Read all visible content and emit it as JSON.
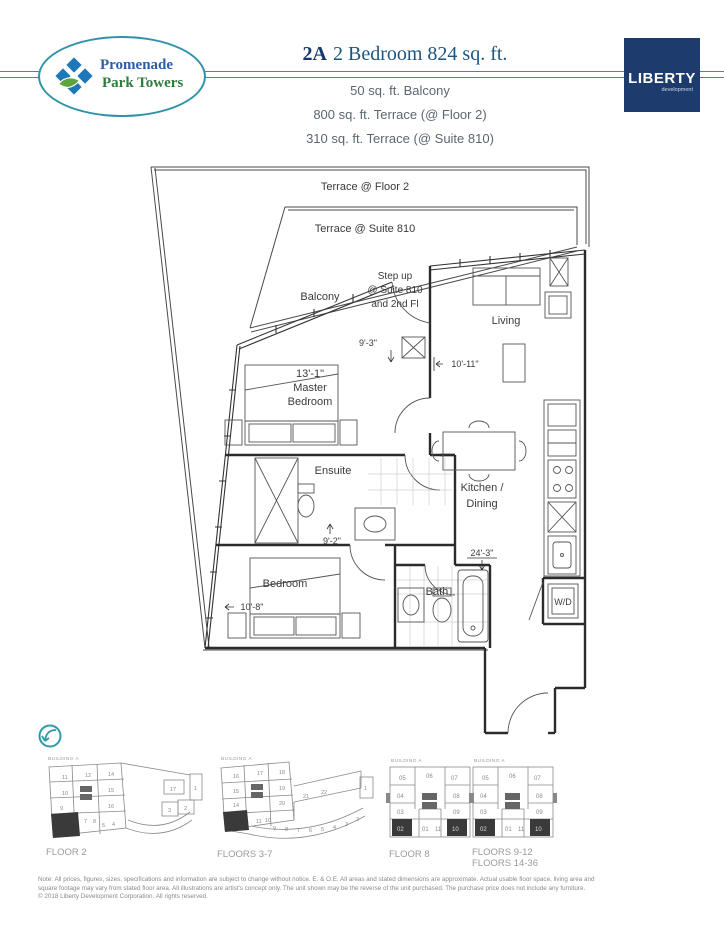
{
  "header": {
    "logo_line1": "Promenade",
    "logo_line2": "Park Towers",
    "unit_code": "2A",
    "unit_desc": "2 Bedroom 824 sq. ft.",
    "subtitles": [
      "50 sq. ft. Balcony",
      "800 sq. ft. Terrace (@ Floor 2)",
      "310 sq. ft. Terrace (@ Suite 810)"
    ],
    "developer_name": "LIBERTY",
    "developer_sub": "development"
  },
  "colors": {
    "brand_teal": "#2e93a9",
    "logo_blue": "#2b5ea7",
    "logo_green": "#2e7d3f",
    "title_navy": "#14386e",
    "liberty_navy": "#1d3c6d",
    "plan_line": "#2b2b2b",
    "keyplan_gray": "#8a8a8a"
  },
  "floorplan": {
    "terrace_floor2": "Terrace @ Floor 2",
    "terrace_suite": "Terrace @ Suite 810",
    "balcony": "Balcony",
    "step_up_1": "Step up",
    "step_up_2": "@ Suite 810",
    "step_up_3": "and 2nd Fl",
    "living": "Living",
    "master_dim": "13'-1\"",
    "master_1": "Master",
    "master_2": "Bedroom",
    "ensuite": "Ensuite",
    "kitchen_1": "Kitchen /",
    "kitchen_2": "Dining",
    "bedroom": "Bedroom",
    "bath": "Bath",
    "wd": "W/D",
    "dim_9_3": "9'-3\"",
    "dim_10_11": "10'-11\"",
    "dim_9_2": "9'-2\"",
    "dim_10_8": "10'-8\"",
    "dim_24_3": "24'-3\""
  },
  "keyplans": {
    "building_label": "BUILDING A",
    "floor2": {
      "label": "FLOOR 2",
      "units": [
        "11",
        "12",
        "14",
        "10",
        "15",
        "9",
        "16",
        "7",
        "8",
        "5",
        "4",
        "17",
        "1",
        "3",
        "2"
      ]
    },
    "floors37": {
      "label": "FLOORS 3-7",
      "units": [
        "16",
        "17",
        "18",
        "15",
        "19",
        "14",
        "20",
        "11",
        "10",
        "9",
        "8",
        "7",
        "6",
        "5",
        "4",
        "3",
        "2",
        "21",
        "22",
        "1"
      ]
    },
    "floor8": {
      "label": "FLOOR 8",
      "units": [
        "05",
        "06",
        "07",
        "04",
        "08",
        "03",
        "09",
        "02",
        "01",
        "11",
        "10"
      ]
    },
    "floors912": {
      "label1": "FLOORS 9-12",
      "label2": "FLOORS 14-36",
      "units": [
        "05",
        "06",
        "07",
        "04",
        "08",
        "03",
        "09",
        "02",
        "01",
        "11",
        "10"
      ]
    }
  },
  "footer": {
    "line1": "Note: All prices, figures, sizes, specifications and information are subject to change without notice. E. & O.E. All areas and stated dimensions are approximate. Actual usable floor space, living area and",
    "line2": "square footage may vary from stated floor area. All illustrations are artist's concept only. The unit shown may be the reverse of the unit purchased. The purchase price does not include any furniture.",
    "line3": "© 2018 Liberty Development Corporation. All rights reserved."
  }
}
